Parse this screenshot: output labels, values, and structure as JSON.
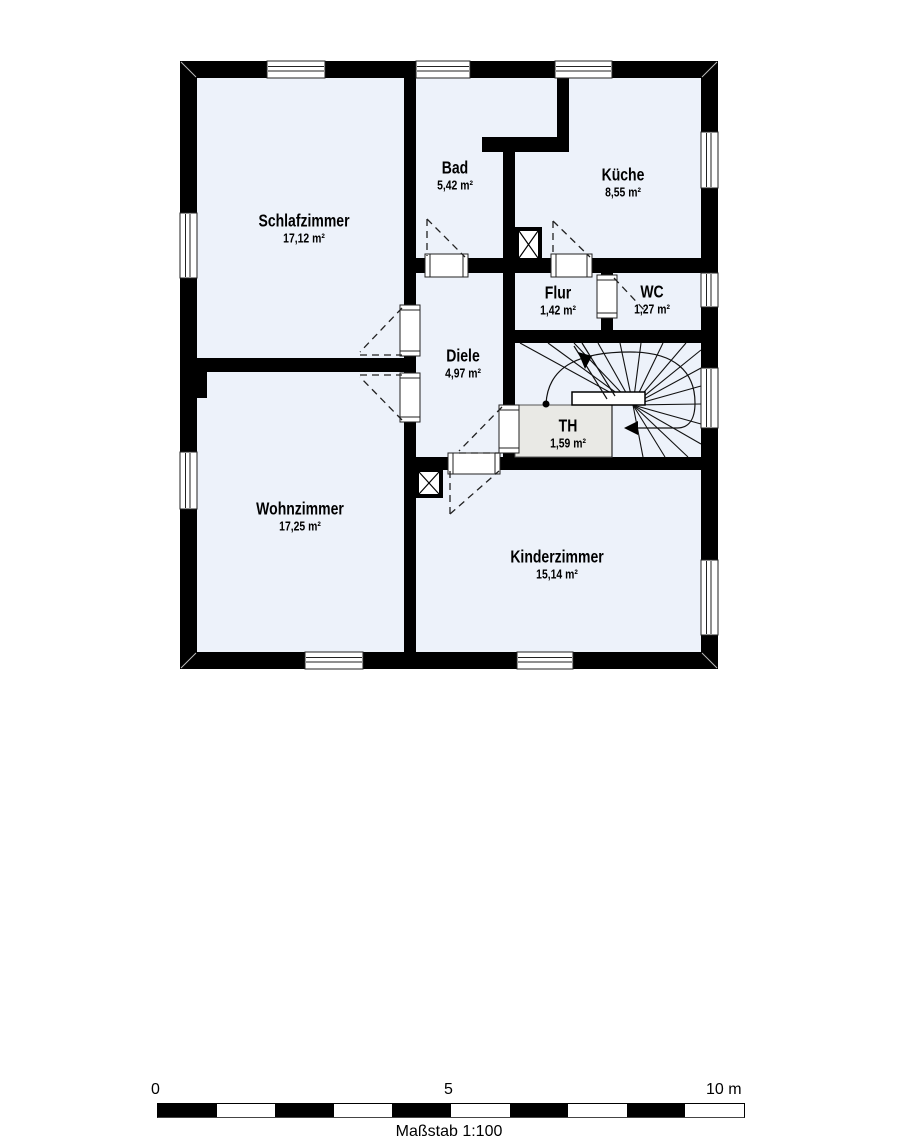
{
  "plan": {
    "rooms": [
      {
        "name": "Schlafzimmer",
        "area": "17,12 m²"
      },
      {
        "name": "Bad",
        "area": "5,42 m²"
      },
      {
        "name": "Küche",
        "area": "8,55 m²"
      },
      {
        "name": "Flur",
        "area": "1,42 m²"
      },
      {
        "name": "WC",
        "area": "1,27 m²"
      },
      {
        "name": "Diele",
        "area": "4,97 m²"
      },
      {
        "name": "TH",
        "area": "1,59 m²"
      },
      {
        "name": "Wohnzimmer",
        "area": "17,25 m²"
      },
      {
        "name": "Kinderzimmer",
        "area": "15,14 m²"
      }
    ],
    "colors": {
      "room_fill": "#edf2fa",
      "stairwell_fill": "#e9e9e5",
      "wall": "#000000"
    }
  },
  "scale_bar": {
    "tick_start": "0",
    "tick_middle": "5",
    "tick_end": "10 m",
    "caption": "Maßstab 1:100"
  }
}
